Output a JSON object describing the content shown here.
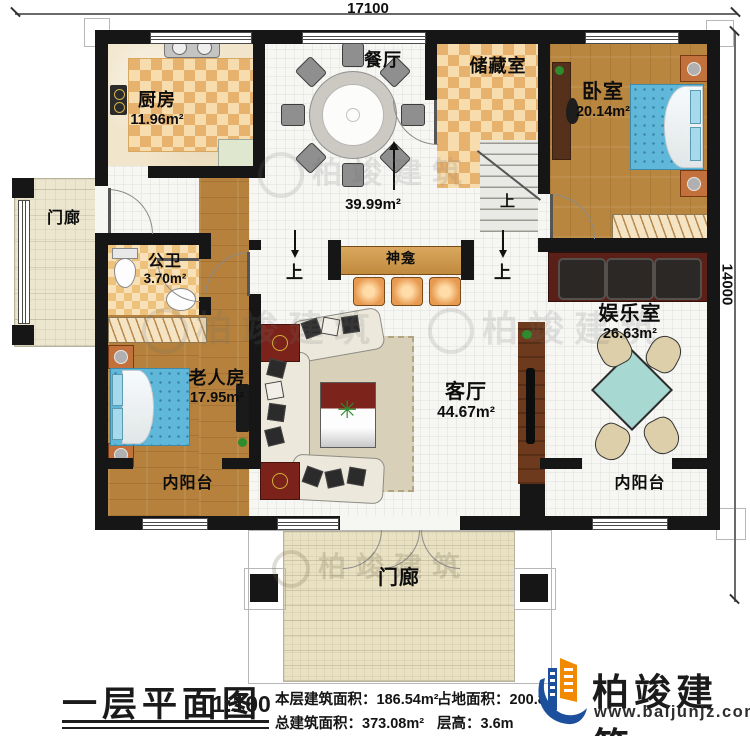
{
  "dimensions": {
    "top": "17100",
    "right": "14000"
  },
  "rooms": {
    "kitchen": {
      "name": "厨房",
      "area": "11.96m²"
    },
    "dining": {
      "name": "餐厅"
    },
    "storage": {
      "name": "储藏室"
    },
    "bedroom": {
      "name": "卧室",
      "area": "20.14m²"
    },
    "hall": {
      "area": "39.99m²"
    },
    "shrine": {
      "name": "神龛"
    },
    "bath": {
      "name": "公卫",
      "area": "3.70m²"
    },
    "elder": {
      "name": "老人房",
      "area": "17.95m²"
    },
    "living": {
      "name": "客厅",
      "area": "44.67m²"
    },
    "game": {
      "name": "娱乐室",
      "area": "26.63m²"
    },
    "balcony_left": {
      "name": "内阳台"
    },
    "balcony_right": {
      "name": "内阳台"
    },
    "porch_left": {
      "name": "门廊"
    },
    "porch_bottom": {
      "name": "门廊"
    }
  },
  "annotations": {
    "up": "上"
  },
  "footer": {
    "title": "一层平面图",
    "scale": "1:100",
    "stats": [
      {
        "label": "本层建筑面积：",
        "value": "186.54m²"
      },
      {
        "label": "总建筑面积：",
        "value": "373.08m²"
      },
      {
        "label": "占地面积：",
        "value": "200.8"
      },
      {
        "label": "层高：",
        "value": "3.6m"
      }
    ]
  },
  "brand": {
    "name": "柏竣建筑",
    "url": "www.baijunjz.com"
  },
  "watermark": {
    "text": "柏竣建筑"
  }
}
